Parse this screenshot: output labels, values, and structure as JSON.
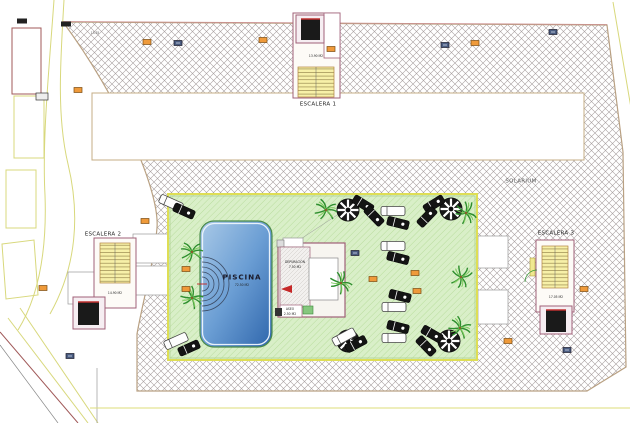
{
  "plan": {
    "stair_labels": {
      "escalera1": "ESCALERA 1",
      "escalera2": "ESCALERA 2",
      "escalera3": "ESCALERA 3"
    },
    "area_labels": {
      "solarium": "SOLARIUM"
    },
    "pool": {
      "name": "PISCINA",
      "area": "72.50 M2"
    },
    "rooms": {
      "depuracion_name": "DEPURACIÓN",
      "depuracion_area": "7.50 M2",
      "aseo_name": "ASEO",
      "aseo_area": "2.50 M2"
    },
    "levels": {
      "esc1_landing": "13.90 M2",
      "esc2_landing": "14.90 M2",
      "esc3_landing": "17.05 M2",
      "roof_note": "13.35"
    },
    "colors": {
      "hatch_line": "#a8a0a0",
      "terrace_border": "#b9a183",
      "deck_green": "#d9efc8",
      "deck_border": "#dede55",
      "pool_light": "#a9c9e7",
      "pool_dark": "#2f66ac",
      "stair_yellow": "#f7f0a8",
      "structure_outline": "#a06078",
      "marker_orange": "#ef9a3a",
      "band_yellow": "#d8d87c"
    },
    "furniture": {
      "parasols": [
        {
          "x": 348,
          "y": 210
        },
        {
          "x": 451,
          "y": 209
        },
        {
          "x": 348,
          "y": 341
        },
        {
          "x": 449,
          "y": 341
        }
      ],
      "palms": [
        {
          "x": 192,
          "y": 252,
          "r": 0
        },
        {
          "x": 192,
          "y": 298,
          "r": 40
        },
        {
          "x": 326,
          "y": 210,
          "r": 15
        },
        {
          "x": 466,
          "y": 213,
          "r": 70
        },
        {
          "x": 461,
          "y": 277,
          "r": 110
        },
        {
          "x": 460,
          "y": 328,
          "r": 30
        },
        {
          "x": 341,
          "y": 283,
          "r": 55
        }
      ],
      "loungers": [
        {
          "x": 171,
          "y": 203,
          "r": 24,
          "t": "w"
        },
        {
          "x": 184,
          "y": 211,
          "r": 24,
          "t": "b"
        },
        {
          "x": 363,
          "y": 204,
          "r": 32,
          "t": "b"
        },
        {
          "x": 374,
          "y": 216,
          "r": 46,
          "t": "b"
        },
        {
          "x": 434,
          "y": 204,
          "r": -32,
          "t": "b"
        },
        {
          "x": 427,
          "y": 217,
          "r": -46,
          "t": "b"
        },
        {
          "x": 393,
          "y": 211,
          "r": 0,
          "t": "w"
        },
        {
          "x": 398,
          "y": 223,
          "r": 14,
          "t": "b"
        },
        {
          "x": 393,
          "y": 246,
          "r": 0,
          "t": "w"
        },
        {
          "x": 398,
          "y": 258,
          "r": 14,
          "t": "b"
        },
        {
          "x": 400,
          "y": 296,
          "r": 14,
          "t": "b"
        },
        {
          "x": 394,
          "y": 307,
          "r": 0,
          "t": "w"
        },
        {
          "x": 398,
          "y": 327,
          "r": 14,
          "t": "b"
        },
        {
          "x": 394,
          "y": 338,
          "r": 0,
          "t": "w"
        },
        {
          "x": 344,
          "y": 337,
          "r": -28,
          "t": "w"
        },
        {
          "x": 356,
          "y": 344,
          "r": -28,
          "t": "b"
        },
        {
          "x": 432,
          "y": 334,
          "r": 30,
          "t": "b"
        },
        {
          "x": 426,
          "y": 346,
          "r": 46,
          "t": "b"
        },
        {
          "x": 176,
          "y": 341,
          "r": -24,
          "t": "w"
        },
        {
          "x": 189,
          "y": 348,
          "r": -24,
          "t": "b"
        }
      ],
      "markers": [
        {
          "x": 147,
          "y": 42,
          "t": "o"
        },
        {
          "x": 263,
          "y": 40,
          "t": "o"
        },
        {
          "x": 475,
          "y": 43,
          "t": "o"
        },
        {
          "x": 331,
          "y": 49,
          "t": "o"
        },
        {
          "x": 78,
          "y": 90,
          "t": "o"
        },
        {
          "x": 145,
          "y": 221,
          "t": "o"
        },
        {
          "x": 186,
          "y": 269,
          "t": "o"
        },
        {
          "x": 186,
          "y": 289,
          "t": "o"
        },
        {
          "x": 373,
          "y": 279,
          "t": "o"
        },
        {
          "x": 415,
          "y": 273,
          "t": "o"
        },
        {
          "x": 417,
          "y": 291,
          "t": "o"
        },
        {
          "x": 43,
          "y": 288,
          "t": "o"
        },
        {
          "x": 584,
          "y": 289,
          "t": "o"
        },
        {
          "x": 508,
          "y": 341,
          "t": "o"
        },
        {
          "x": 178,
          "y": 43,
          "t": "g"
        },
        {
          "x": 445,
          "y": 45,
          "t": "g"
        },
        {
          "x": 553,
          "y": 32,
          "t": "g"
        },
        {
          "x": 355,
          "y": 253,
          "t": "g"
        },
        {
          "x": 567,
          "y": 350,
          "t": "g"
        },
        {
          "x": 70,
          "y": 356,
          "t": "g"
        },
        {
          "x": 22,
          "y": 21,
          "t": "b"
        },
        {
          "x": 66,
          "y": 24,
          "t": "b"
        }
      ]
    }
  }
}
